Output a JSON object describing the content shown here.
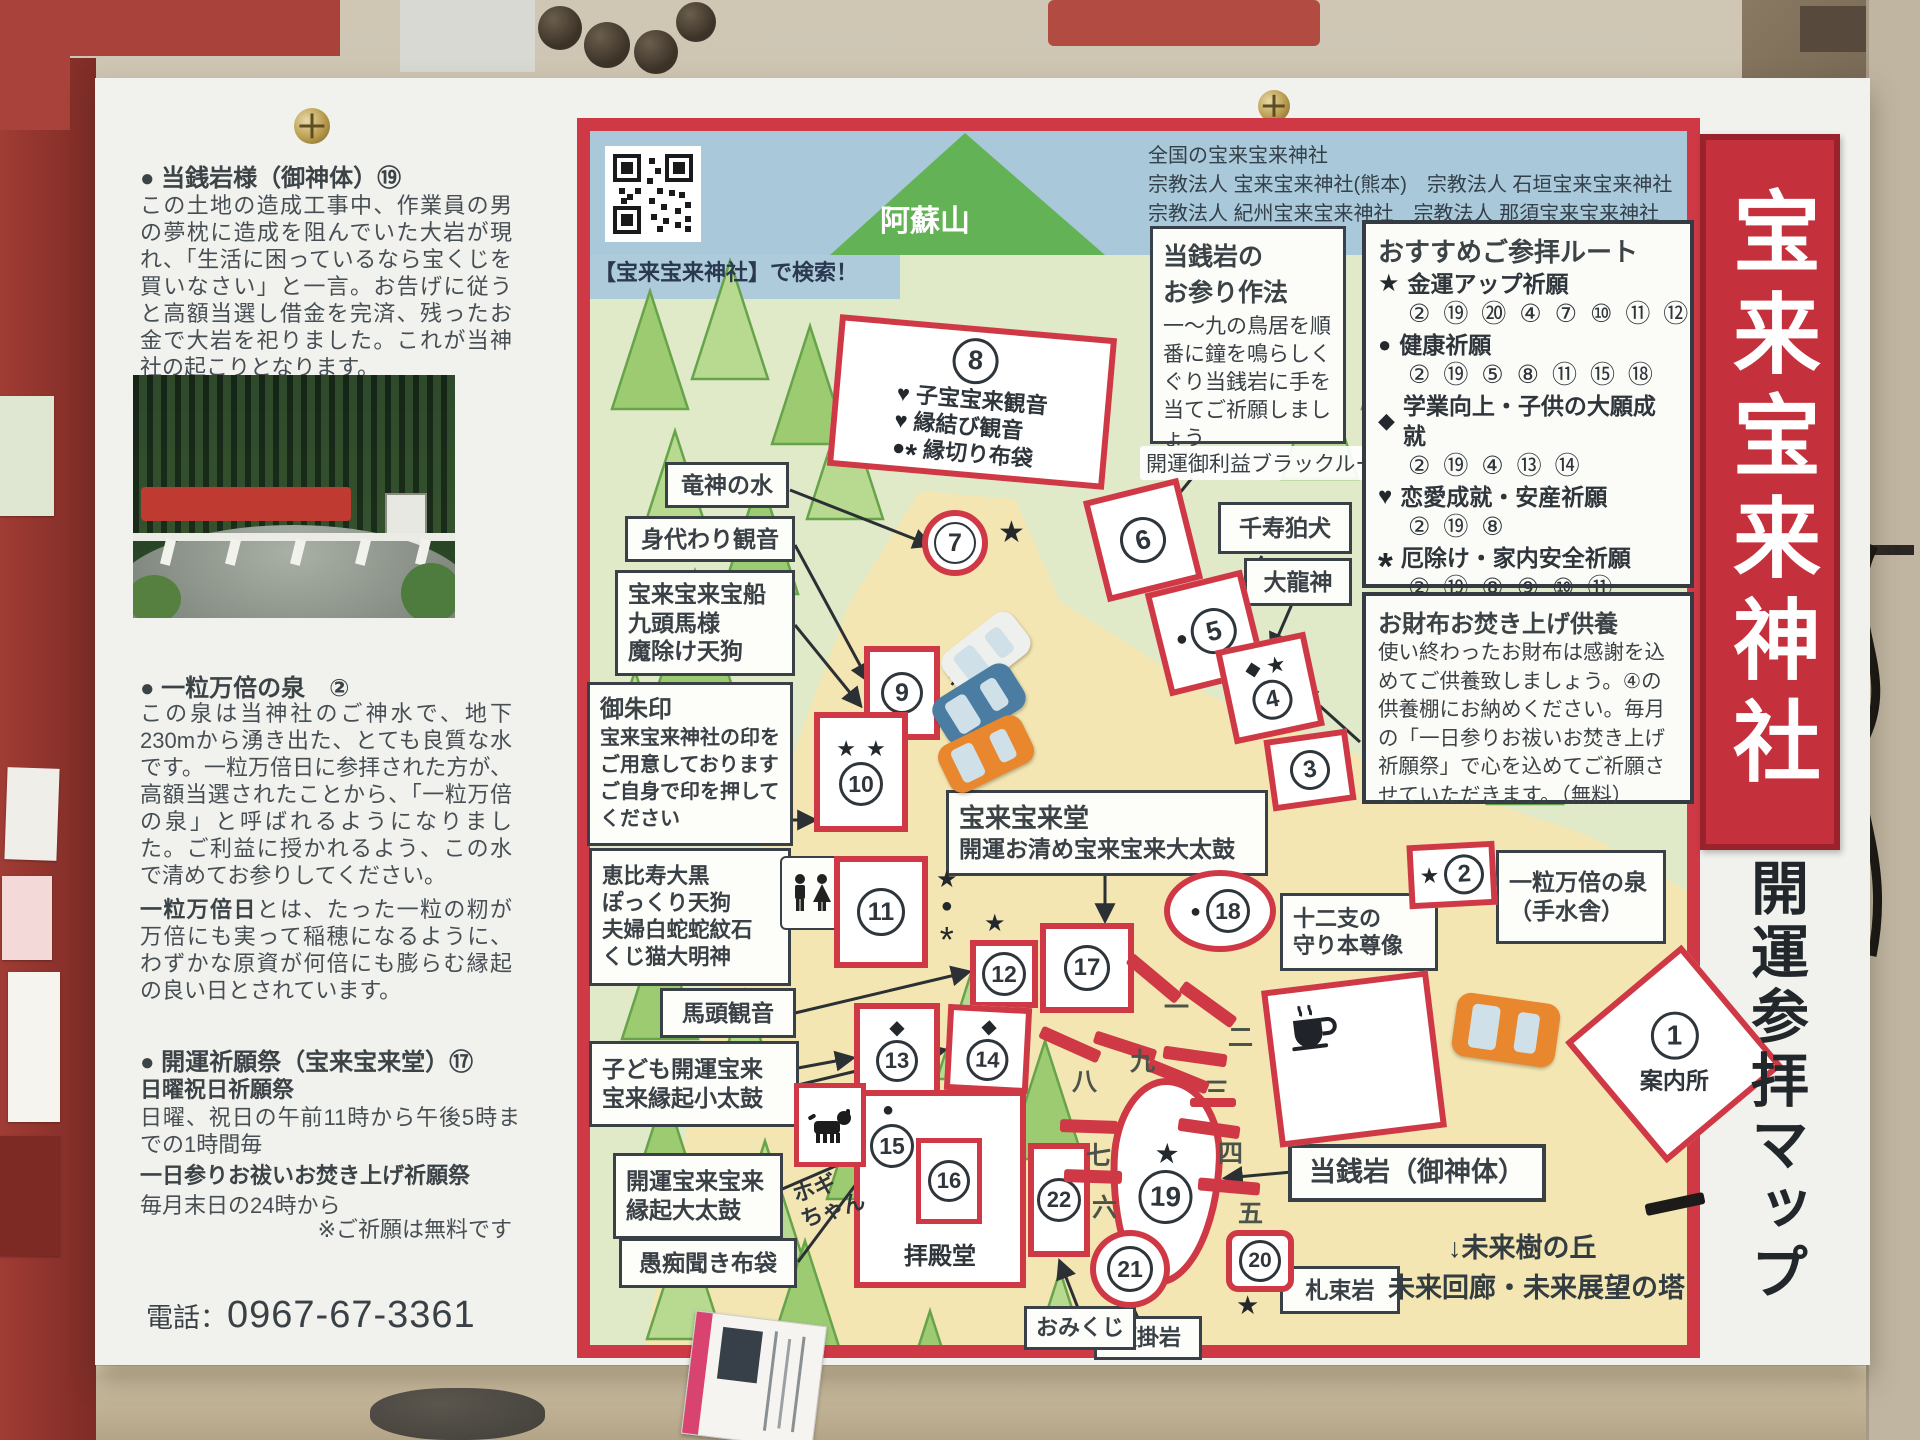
{
  "left": {
    "s1_heading": "● 当銭岩様（御神体）⑲",
    "s1_body": "この土地の造成工事中、作業員の男の夢枕に造成を阻んでいた大岩が現れ、「生活に困っているなら宝くじを買いなさい」と一言。お告げに従うと高額当選し借金を完済、残ったお金で大岩を祀りました。これが当神社の起こりとなります。",
    "s2_heading": "● 一粒万倍の泉　②",
    "s2_body": "この泉は当神社のご神水で、地下230mから湧き出た、とても良質な水です。一粒万倍日に参拝された方が、高額当選されたことから、「一粒万倍の泉」と呼ばれるようになりました。ご利益に授かれるよう、この水で清めてお参りしてください。",
    "s2_term": "一粒万倍日",
    "s2_term_rest": "とは、たった一粒の籾が万倍にも実って稲穂になるように、わずかな原資が何倍にも膨らむ縁起の良い日とされています。",
    "s3_heading": "● 開運祈願祭（宝来宝来堂）⑰",
    "s3_sub1": "日曜祝日祈願祭",
    "s3_line1": "日曜、祝日の午前11時から午後5時までの1時間毎",
    "s3_sub2": "一日参りお祓いお焚き上げ祈願祭",
    "s3_line2": "毎月末日の24時から",
    "s3_note": "※ご祈願は無料です",
    "phone_label": "電話：",
    "phone_number": "0967-67-3361"
  },
  "top": {
    "qr_caption": "【宝来宝来神社】で検索！",
    "mountain": "阿蘇山",
    "net_title": "全国の宝来宝来神社",
    "net_l2": "宗教法人 宝来宝来神社(熊本)　宗教法人 石垣宝来宝来神社",
    "net_l3": "宗教法人 紀州宝来宝来神社　宗教法人 那須宝来宝来神社"
  },
  "worship": {
    "t1": "当銭岩の",
    "t2": "お参り作法",
    "body": "一〜九の鳥居を順番に鐘を鳴らしくぐり当銭岩に手を当てご祈願しましょう"
  },
  "routes": {
    "title": "おすすめご参拝ルート",
    "r1": {
      "sym": "★",
      "label": "金運アップ祈願",
      "stops": "② ⑲ ⑳ ④ ⑦ ⑩ ⑪ ⑫"
    },
    "r2": {
      "sym": "●",
      "label": "健康祈願",
      "stops": "② ⑲ ⑤ ⑧ ⑪ ⑮ ⑱"
    },
    "r3": {
      "sym": "◆",
      "label": "学業向上・子供の大願成就",
      "stops": "② ⑲ ④ ⑬ ⑭"
    },
    "r4": {
      "sym": "♥",
      "label": "恋愛成就・安産祈願",
      "stops": "② ⑲ ⑧"
    },
    "r5": {
      "sym": "*",
      "label": "厄除け・家内安全祈願",
      "stops": "② ⑲ ⑧ ⑨ ⑩ ⑪"
    }
  },
  "wallet": {
    "title": "お財布お焚き上げ供養",
    "body": "使い終わったお財布は感謝を込めてご供養致しましょう。④の供養棚にお納めください。毎月の「一日参りお祓いお焚き上げ祈願祭」で心を込めてご祈願させていただきます。（無料）"
  },
  "banner": {
    "main": "宝来宝来神社",
    "sub": "開運参拝マップ"
  },
  "labels": {
    "blackroom": "開運御利益ブラックルーム",
    "ryujin": "竜神の水",
    "migawari": "身代わり観音",
    "takara1": "宝来宝来宝船",
    "takara2": "九頭馬様",
    "takara3": "魔除け天狗",
    "goshuin_t": "御朱印",
    "goshuin_b": "宝来宝来神社の印をご用意しております　ご自身で印を押してください",
    "ebisu1": "恵比寿大黒",
    "ebisu2": "ぽっくり天狗",
    "ebisu3": "夫婦白蛇蛇紋石",
    "ebisu4": "くじ猫大明神",
    "bato": "馬頭観音",
    "kodomo1": "子ども開運宝来",
    "kodomo2": "宝来縁起小太鼓",
    "taiko1": "開運宝来宝来",
    "taiko2": "縁起大太鼓",
    "guchi": "愚痴聞き布袋",
    "senju": "千寿狛犬",
    "dairyu": "大龍神",
    "junishi1": "十二支の",
    "junishi2": "守り本尊像",
    "izumi1": "一粒万倍の泉",
    "izumi2": "（手水舎）",
    "horaido_t": "宝来宝来堂",
    "horaido_b": "開運お清め宝来宝来大太鼓",
    "tosengan": "当銭岩（御神体）",
    "satsutaba": "札束岩",
    "gankake": "願掛岩",
    "omikuji": "おみくじ",
    "haiden": "拝殿堂",
    "annaijo": "案内所",
    "hogi1": "ホギ",
    "hogi2": "ちゃん",
    "mirai1": "↓未来樹の丘",
    "mirai2": "未来回廊・未来展望の塔"
  },
  "spots": {
    "n1": "1",
    "n2": "2",
    "n3": "3",
    "n4": "4",
    "n5": "5",
    "n6": "6",
    "n7": "7",
    "n8": "8",
    "n9": "9",
    "n10": "10",
    "n11": "11",
    "n12": "12",
    "n13": "13",
    "n14": "14",
    "n15": "15",
    "n16": "16",
    "n17": "17",
    "n18": "18",
    "n19": "19",
    "n20": "20",
    "n21": "21",
    "n22": "22",
    "s8_r1": "子宝宝来観音",
    "s8_r2": "縁結び観音",
    "s8_r3": "縁切り布袋"
  },
  "syms": {
    "star": "★",
    "dot": "●",
    "dia": "◆",
    "heart": "♥",
    "ast": "*"
  },
  "torii": [
    "一",
    "二",
    "三",
    "四",
    "五",
    "六",
    "七",
    "八",
    "九"
  ]
}
